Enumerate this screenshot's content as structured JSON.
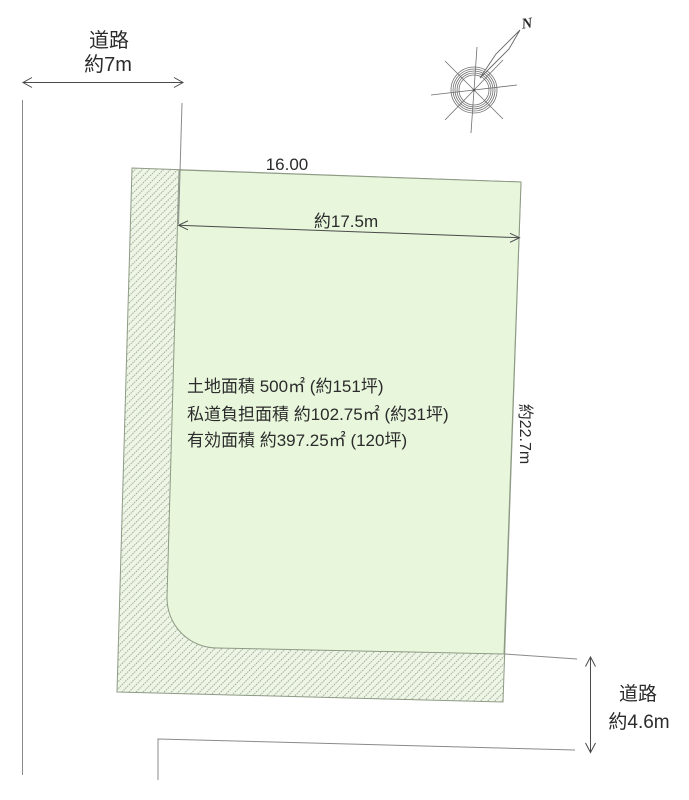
{
  "colors": {
    "background": "#ffffff",
    "plot_fill": "#e8f6dc",
    "burden_fill": "#eef4e6",
    "hatch_line": "#8ca181",
    "plot_stroke": "#8e9b85",
    "dimension_line": "#4a4a4a",
    "road_line": "#8a8a8a",
    "text": "#2b2b2b"
  },
  "compass": {
    "north_label": "N"
  },
  "left_road": {
    "label": "道路",
    "width": "約7m"
  },
  "bottom_road": {
    "label": "道路",
    "width": "約4.6m"
  },
  "dimensions": {
    "top_edge": "16.00",
    "frontage": "約17.5m",
    "depth": "約22.7m"
  },
  "areas": {
    "land": "土地面積  500㎡  (約151坪)",
    "private_road_burden": "私道負担面積  約102.75㎡  (約31坪)",
    "effective": "有効面積  約397.25㎡  (120坪)"
  }
}
